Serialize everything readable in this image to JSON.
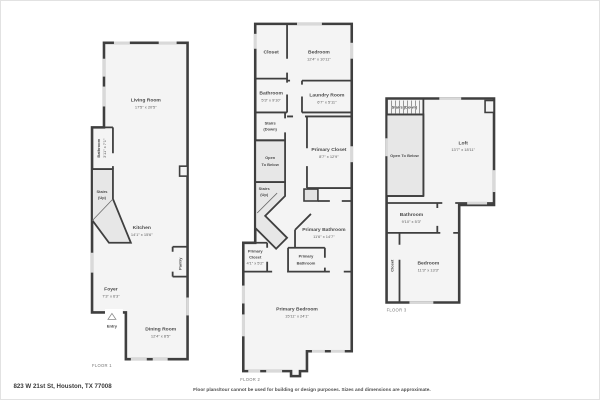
{
  "page": {
    "address": "823 W 21st St, Houston, TX 77008",
    "disclaimer": "Floor plans/tour cannot be used for building or design purposes. Sizes and dimensions are approximate."
  },
  "colors": {
    "wall": "#3f3f3f",
    "room_fill": "#f4f4f4",
    "stair_fill": "#e7e7e7",
    "window": "#d9d9d9",
    "label_text": "#4a4a4a",
    "background": "#ffffff"
  },
  "floors": [
    {
      "label": "FLOOR 1",
      "rooms": [
        {
          "id": "living-room",
          "lines": [
            "Living Room",
            "17'5\" x 20'5\""
          ]
        },
        {
          "id": "bathroom",
          "lines": [
            "Bathroom",
            "3'11\" x 7'1\""
          ]
        },
        {
          "id": "stairs-up",
          "lines": [
            "Stairs",
            "(Up)"
          ]
        },
        {
          "id": "kitchen",
          "lines": [
            "Kitchen",
            "14'1\" x 15'6\""
          ]
        },
        {
          "id": "pantry",
          "lines": [
            "Pantry"
          ]
        },
        {
          "id": "foyer",
          "lines": [
            "Foyer",
            "7'3\" x 6'3\""
          ]
        },
        {
          "id": "entry",
          "lines": [
            "Entry"
          ]
        },
        {
          "id": "dining-room",
          "lines": [
            "Dining Room",
            "12'4\" x 8'5\""
          ]
        }
      ]
    },
    {
      "label": "FLOOR 2",
      "rooms": [
        {
          "id": "closet",
          "lines": [
            "Closet"
          ]
        },
        {
          "id": "bedroom",
          "lines": [
            "Bedroom",
            "12'4\" x 10'11\""
          ]
        },
        {
          "id": "bathroom",
          "lines": [
            "Bathroom",
            "5'3\" x 9'10\""
          ]
        },
        {
          "id": "laundry-room",
          "lines": [
            "Laundry Room",
            "6'7\" x 5'11\""
          ]
        },
        {
          "id": "stairs-down",
          "lines": [
            "Stairs",
            "(Down)"
          ]
        },
        {
          "id": "open-to-below",
          "lines": [
            "Open",
            "To Below"
          ]
        },
        {
          "id": "primary-closet",
          "lines": [
            "Primary Closet",
            "8'7\" x 12'9\""
          ]
        },
        {
          "id": "stairs-up",
          "lines": [
            "Stairs",
            "(Up)"
          ]
        },
        {
          "id": "primary-bathroom",
          "lines": [
            "Primary Bathroom",
            "11'6\" x 14'7\""
          ]
        },
        {
          "id": "primary-closet-2",
          "lines": [
            "Primary",
            "Closet",
            "4'1\" x 5'2\""
          ]
        },
        {
          "id": "primary-bathroom-2",
          "lines": [
            "Primary",
            "Bathroom"
          ]
        },
        {
          "id": "primary-bedroom",
          "lines": [
            "Primary Bedroom",
            "15'11\" x 24'1\""
          ]
        }
      ]
    },
    {
      "label": "FLOOR 3",
      "rooms": [
        {
          "id": "stairs-down",
          "lines": [
            "Stairs (Down)"
          ]
        },
        {
          "id": "loft",
          "lines": [
            "Loft",
            "13'7\" x 18'11\""
          ]
        },
        {
          "id": "open-to-below",
          "lines": [
            "Open To Below"
          ]
        },
        {
          "id": "bathroom",
          "lines": [
            "Bathroom",
            "9'10\" x 5'3\""
          ]
        },
        {
          "id": "closet",
          "lines": [
            "Closet"
          ]
        },
        {
          "id": "bedroom",
          "lines": [
            "Bedroom",
            "11'3\" x 13'3\""
          ]
        }
      ]
    }
  ]
}
